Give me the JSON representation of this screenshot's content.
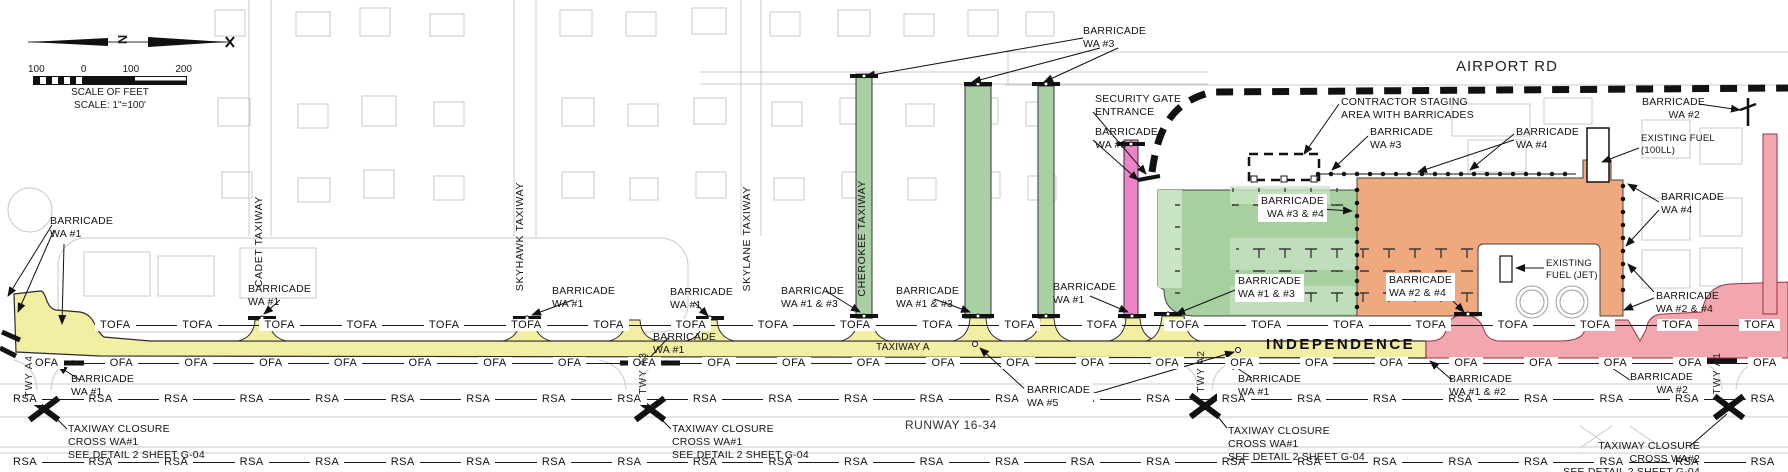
{
  "compass": {
    "north_label": "N"
  },
  "scalebar": {
    "ticks": [
      "100",
      "0",
      "100",
      "200"
    ],
    "caption_line1": "SCALE OF FEET",
    "caption_line2": "SCALE: 1\"=100'"
  },
  "roads": {
    "airport_rd": "AIRPORT RD"
  },
  "taxiways": {
    "cadet": "CADET TAXIWAY",
    "skyhawk": "SKYHAWK TAXIWAY",
    "skylane": "SKYLANE TAXIWAY",
    "cherokee": "CHEROKEE TAXIWAY",
    "taxiway_a": "TAXIWAY A",
    "independence": "INDEPENDENCE",
    "twy_a1": "TWY A1",
    "twy_a2": "TWY A2",
    "twy_a3": "TWY A3",
    "twy_a4": "TWY A4"
  },
  "runway": {
    "name": "RUNWAY 16-34"
  },
  "barricades": {
    "wa1": "BARRICADE\nWA #1",
    "wa2": "BARRICADE\nWA #2",
    "wa3": "BARRICADE\nWA #3",
    "wa4": "BARRICADE\nWA #4",
    "wa5": "BARRICADE\nWA #5",
    "wa1_2": "BARRICADE\nWA #1 & #2",
    "wa1_3": "BARRICADE\nWA #1 & #3",
    "wa2_4": "BARRICADE\nWA #2 & #4",
    "wa3_4": "BARRICADE\nWA #3 & #4"
  },
  "notes": {
    "security_gate": "SECURITY GATE\nENTRANCE",
    "contractor_staging": "CONTRACTOR STAGING\nAREA WITH BARRICADES",
    "existing_fuel_100ll": "EXISTING FUEL\n(100LL)",
    "existing_fuel_jet": "EXISTING\nFUEL (JET)",
    "closure_wa1": "TAXIWAY CLOSURE\nCROSS WA#1\nSEE DETAIL 2 SHEET G-04",
    "closure_wa2": "TAXIWAY CLOSURE\nCROSS WA#2\nSEE DETAIL 2 SHEET G-04"
  },
  "rows": {
    "tofa": {
      "label": "TOFA",
      "count": 21
    },
    "ofa": {
      "label": "OFA",
      "count": 24
    },
    "rsa_upper": {
      "label": "RSA",
      "count": 24
    },
    "rsa_lower": {
      "label": "RSA",
      "count": 24
    }
  },
  "colors": {
    "closed_taxiway_yellow": "#F2EFA2",
    "closed_connector_green": "#A9CFA4",
    "staging_area_green": "#A8CFA0",
    "staging_area_orange": "#F0A87E",
    "closed_area_pink": "#F2A6AD",
    "closed_connector_magenta": "#EE82C8"
  }
}
